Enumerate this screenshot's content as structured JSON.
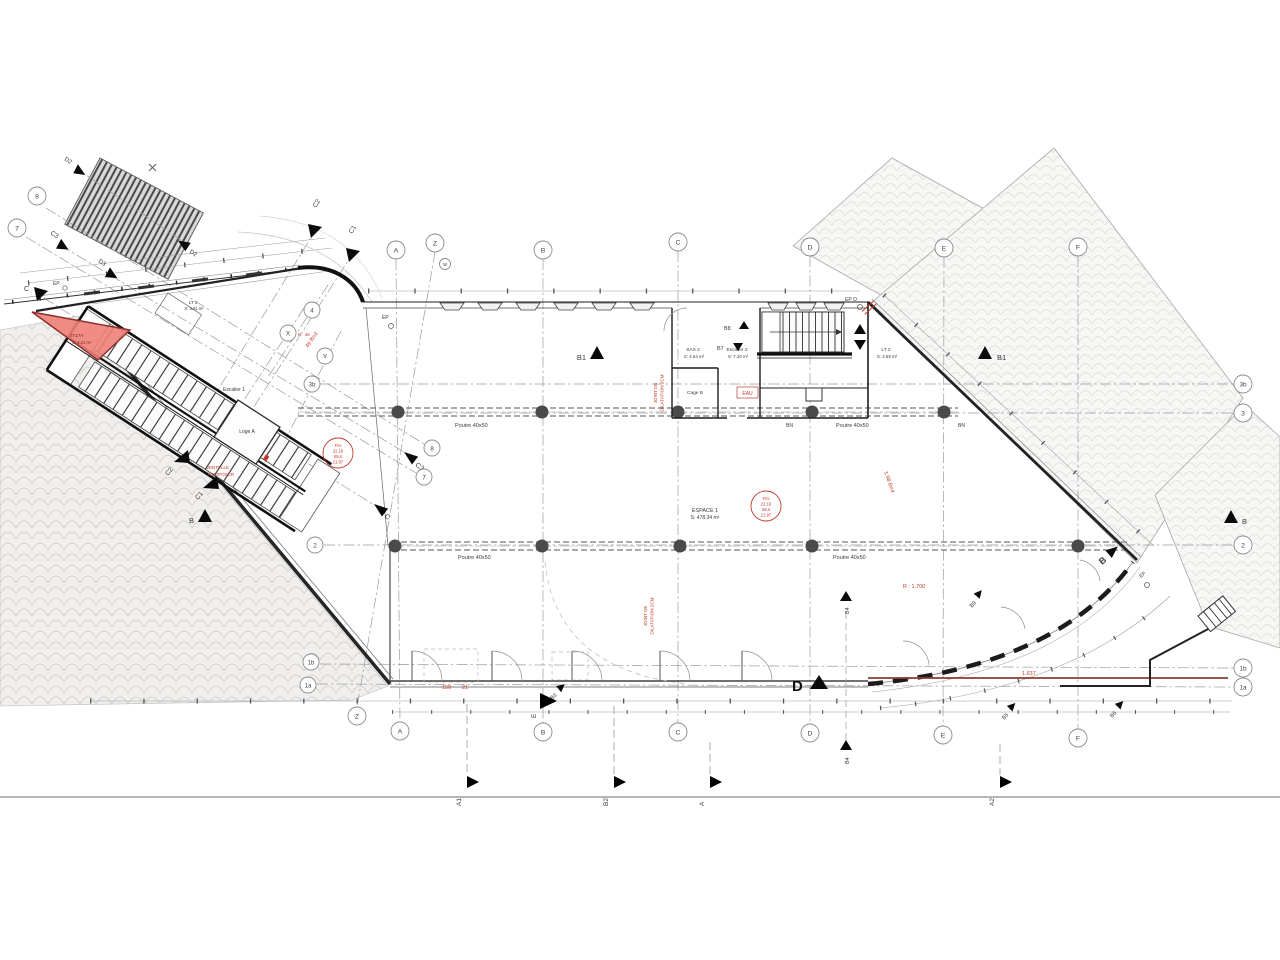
{
  "colors": {
    "annotation_red": "#c0392b",
    "demolition_fill": "#ec8078",
    "wall": "#1c1c1c",
    "hatch_line": "#cfccc8",
    "column": "#4a4a4a",
    "grid_line": "#9a9a9a"
  },
  "grid": {
    "top": [
      "A",
      "Z",
      "w",
      "B",
      "C",
      "D",
      "E",
      "F"
    ],
    "bottom": [
      "Z",
      "A",
      "B",
      "C",
      "D",
      "E",
      "F"
    ],
    "left": [
      "8",
      "7"
    ],
    "right": [
      "3b",
      "3",
      "2",
      "1b",
      "1a"
    ],
    "mid": [
      "4",
      "X",
      "Y",
      "3b",
      "2",
      "1b",
      "1a",
      "8",
      "7"
    ]
  },
  "rooms": {
    "espace1_name": "ESPACE 1",
    "espace1_area": "S: 478.34 m²",
    "sas2_name": "SAS 2",
    "sas2_area": "S: 4.64 m²",
    "escalier2_name": "Escalier 2",
    "escalier2_area": "S: 7.20 m²",
    "cage_b": "Cage B",
    "escalier1_name": "Escalier 1",
    "loge_a": "Loge A",
    "lt1_name": "LT 1",
    "lt1_area": "S: 3.61 m²",
    "lt2_name": "LT 2",
    "lt2_area": "S: 4.59 m²",
    "demo_name": "2T17A",
    "demo_area": "S: 3.21 m²"
  },
  "structure": {
    "beam_label": "Poutre 40x50",
    "bn": "BN",
    "ep": "EP",
    "ep_o": "EP O"
  },
  "levels": {
    "l1": "Fini",
    "l2": "22.16",
    "l3": "Brut",
    "l4": "21.97"
  },
  "red_notes": {
    "joint_a": "JOINT DE",
    "joint_b": "DILATATION 2CM",
    "eau": "EAU",
    "d150": "150",
    "d21": "21",
    "d1637": "1.637",
    "r1700": "R : 1.700",
    "brut198": "1.98 Brut",
    "brut49": "49 Brut",
    "k46": "K : 46",
    "vent_a": "VENTELLE",
    "vent_b": "A DEPOSER"
  },
  "markers": {
    "b1": "B1",
    "b": "B",
    "d": "D",
    "e": "E",
    "a": "A",
    "b3": "B3",
    "b4": "B4",
    "b5": "B5",
    "b6": "B6",
    "b7": "B7",
    "b8": "B8",
    "b9": "B9",
    "c": "C",
    "c1": "C1",
    "c2": "C2",
    "c3": "C3",
    "d2": "D2",
    "d3": "D3"
  },
  "sections_bottom": [
    "A1",
    "B2",
    "A",
    "A2"
  ]
}
